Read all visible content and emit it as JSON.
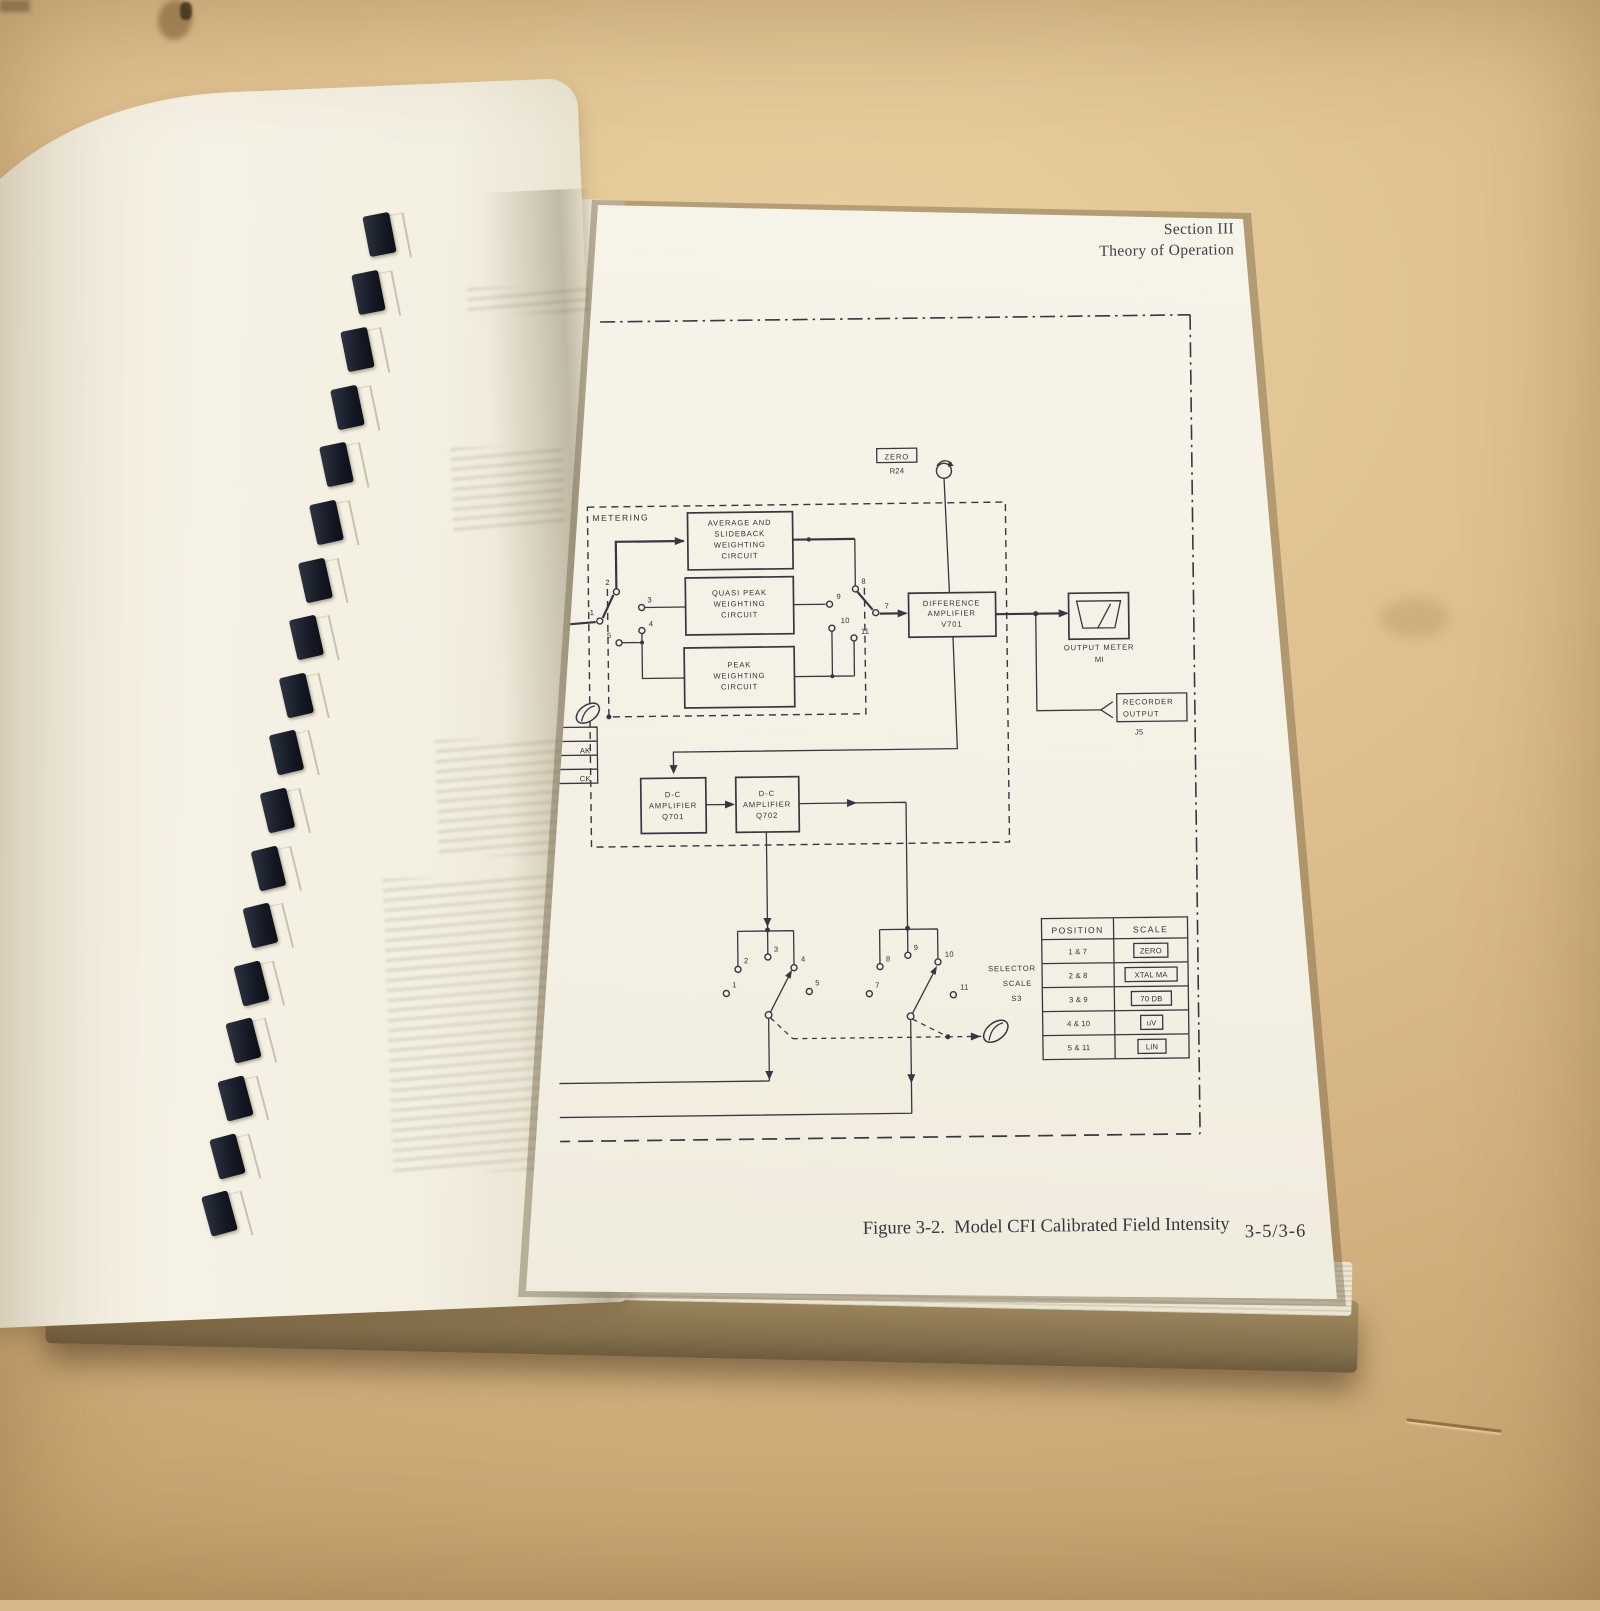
{
  "manual_page": {
    "section_header": [
      "Section III",
      "Theory of Operation"
    ],
    "figure_caption": [
      "Figure 3-2.  Model CFI Calibrated Field Intensity",
      "Receiver, Detailed Block Diagram"
    ],
    "page_number": "3-5/3-6"
  },
  "diagram": {
    "region_label": "METERING",
    "blocks": {
      "average": [
        "AVERAGE AND",
        "SLIDEBACK",
        "WEIGHTING",
        "CIRCUIT"
      ],
      "quasi_peak": [
        "QUASI PEAK",
        "WEIGHTING",
        "CIRCUIT"
      ],
      "peak": [
        "PEAK",
        "WEIGHTING",
        "CIRCUIT"
      ],
      "difference_amplifier": [
        "DIFFERENCE",
        "AMPLIFIER",
        "V701"
      ],
      "dc_amplifier_1": [
        "D-C",
        "AMPLIFIER",
        "Q701"
      ],
      "dc_amplifier_2": [
        "D-C",
        "AMPLIFIER",
        "Q702"
      ]
    },
    "zero_adjust": {
      "label": "ZERO",
      "ref": "R24"
    },
    "output_meter": {
      "label": "OUTPUT METER",
      "ref": "MI"
    },
    "recorder_output": {
      "line1": "RECORDER",
      "line2": "OUTPUT",
      "ref": "J5"
    },
    "selector": {
      "line1": "SELECTOR",
      "line2": "SCALE",
      "line3": "S3"
    },
    "contacts": {
      "c1": "1",
      "c2": "2",
      "c3": "3",
      "c4": "4",
      "c5": "5",
      "c7": "7",
      "c8": "8",
      "c9": "9",
      "c10": "10",
      "c11": "11"
    },
    "clipped_legend": {
      "row1": "AK",
      "row2": "CK"
    },
    "scale_table": {
      "headers": [
        "POSITION",
        "SCALE"
      ],
      "rows": [
        {
          "position": "1 & 7",
          "scale": "ZERO"
        },
        {
          "position": "2 & 8",
          "scale": "XTAL MA"
        },
        {
          "position": "3 & 9",
          "scale": "70 DB"
        },
        {
          "position": "4 & 10",
          "scale": "uV"
        },
        {
          "position": "5 & 11",
          "scale": "LIN"
        }
      ]
    }
  },
  "colors": {
    "ink": "#343842",
    "paper": "#f4f0e4",
    "table_surface": "#d8b78a"
  }
}
